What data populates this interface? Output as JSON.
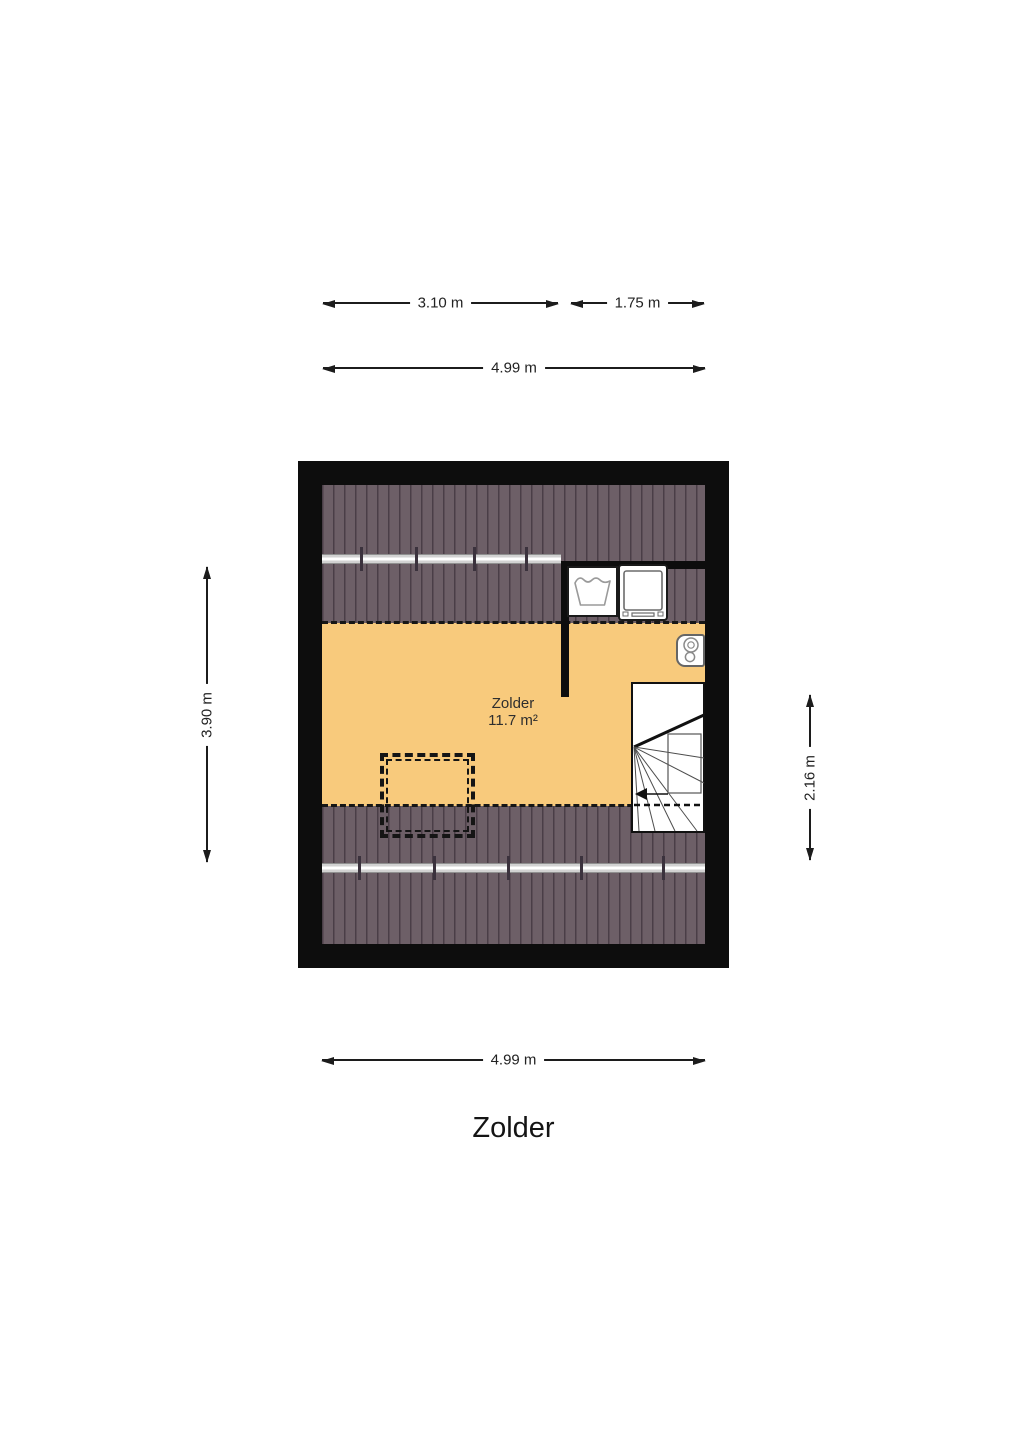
{
  "floor_title": "Zolder",
  "room_label": {
    "name": "Zolder",
    "area": "11.7 m²"
  },
  "dimensions": {
    "top_segment_left": "3.10 m",
    "top_segment_right": "1.75 m",
    "top_total": "4.99 m",
    "bottom_total": "4.99 m",
    "left_height": "3.90 m",
    "right_stair": "2.16 m"
  },
  "objects": {
    "laundry_tub": "laundry-tub-icon",
    "washing_machine": "washing-machine-icon",
    "boiler": "boiler-icon",
    "stairs": "winder-staircase",
    "roof_window": "roof-window-dashed-outline",
    "sloped_roof": "sloped-roof-hatching",
    "beam": "purlin-beam"
  },
  "colors": {
    "wall": "#0d0d0d",
    "floor": "#f8ca7c",
    "sloped_roof": "#6d5f67",
    "roof_stripe": "#4a3e47",
    "beam": "#d2d2d2",
    "dimension_line": "#1c1c1c"
  }
}
